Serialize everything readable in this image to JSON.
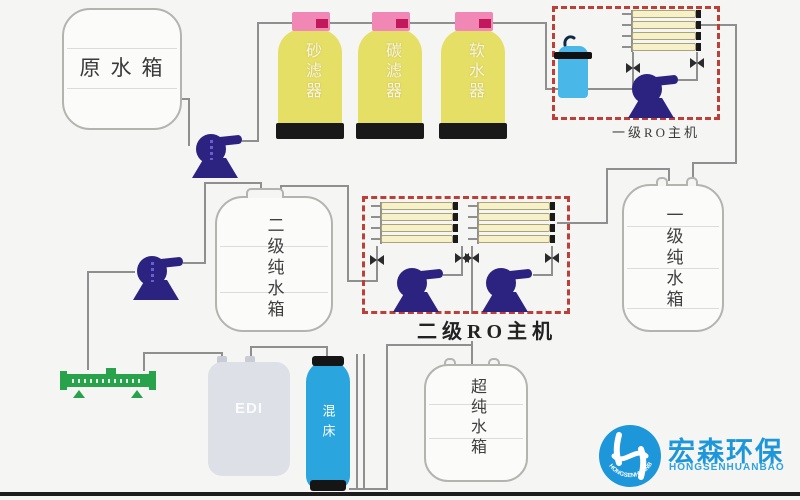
{
  "diagram": {
    "tanks": {
      "raw": {
        "label": "原水箱"
      },
      "stage2_pure": {
        "label": "二级纯水箱"
      },
      "stage1_pure": {
        "label": "一级纯水箱"
      },
      "ultra_pure": {
        "label": "超纯水箱"
      }
    },
    "filters": [
      {
        "label": "砂滤器"
      },
      {
        "label": "碳滤器"
      },
      {
        "label": "软水器"
      }
    ],
    "ro_units": {
      "stage1_label": "一级RO主机",
      "stage2_label": "二级RO主机"
    },
    "equipment": {
      "edi_label": "EDI",
      "mixed_bed_label": "混床"
    },
    "logo": {
      "name_cn": "宏森环保",
      "name_en": "HONGSENHUANBAO",
      "arc_text": "HONGSENHUANBAO"
    },
    "colors": {
      "background": "#f5f5f3",
      "pipe": "#8f8f8f",
      "pump": "#2c2380",
      "filter_body": "#e6df66",
      "filter_cap": "#f187b5",
      "filter_cap_valve": "#c2185b",
      "filter_base": "#191919",
      "membrane": "#f6f1c8",
      "dashed_box": "#bc4038",
      "security_filter": "#49b7e8",
      "mixed_bed": "#2ba5de",
      "edi_body": "#dde0e6",
      "manifold": "#28a34b",
      "tank_outline": "#b3b3b0",
      "logo_blue": "#1e96da"
    }
  }
}
